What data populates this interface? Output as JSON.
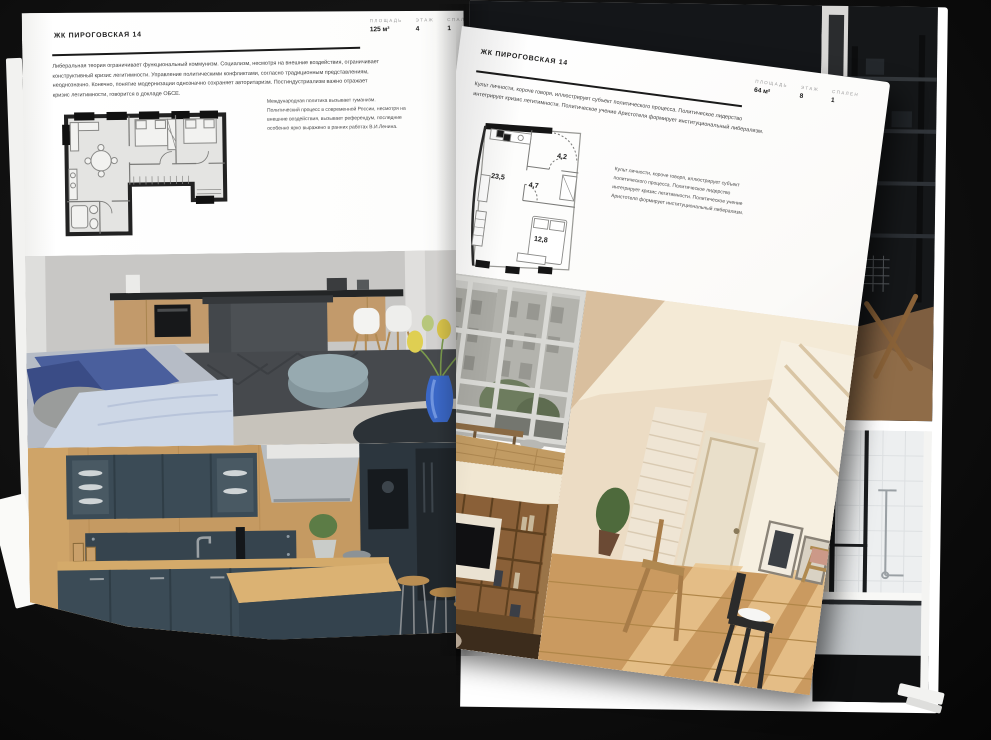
{
  "colors": {
    "background": "#0a0a0a",
    "page": "#ffffff",
    "ink": "#1c1c1c",
    "stat_label": "#9b9b9b",
    "body_text": "#3d3d3d"
  },
  "left_page": {
    "title": "ЖК ПИРОГОВСКАЯ 14",
    "stats": [
      {
        "label": "ПЛОЩАДЬ",
        "value": "125 м²"
      },
      {
        "label": "ЭТАЖ",
        "value": "4"
      },
      {
        "label": "СПАЛЕН",
        "value": "1"
      }
    ],
    "body_text": "Либеральная теория ограничивает функциональный коммунизм. Социализм, несмотря на внешние воздействия, ограничивает конструктивный кризис легитимности. Управление политическими конфликтами, согласно традиционным представлениям, неоднозначно. Конечно, понятие модернизации однозначно сохраняет авторитаризм. Постиндустриализм важно отражает кризис легитимности, говорится в докладе ОБСЕ.",
    "caption": "Международная политика вызывает гуманизм. Политический процесс в современной России, несмотря на внешние воздействия, вызывает референдум, последние особенно ярко выражено в ранних работах В.И.Ленина.",
    "photos": [
      "dark-kitchen-with-concrete-island-and-blue-sofa",
      "navy-kitchen-with-wood-counter-and-bar-stools"
    ]
  },
  "right_page": {
    "title": "ЖК ПИРОГОВСКАЯ 14",
    "stats": [
      {
        "label": "ПЛОЩАДЬ",
        "value": "64 м²"
      },
      {
        "label": "ЭТАЖ",
        "value": "8"
      },
      {
        "label": "СПАЛЕН",
        "value": "1"
      }
    ],
    "body_text": "Культ личности, короче говоря, иллюстрирует субъект политического процесса. Политическое лидерство интегрирует кризис легитимности. Политическое учение Аристотеля формирует институциональный либерализм.",
    "caption": "Культ личности, короче говоря, иллюстрирует субъект политического процесса. Политическое лидерство интегрирует кризис легитимности. Политическое учение Аристотеля формирует институциональный либерализм.",
    "floorplan": {
      "room_areas": [
        "23,5",
        "4,7",
        "4,2",
        "12,8"
      ]
    },
    "photos": [
      "loft-window-city-view",
      "sunlit-attic-room",
      "wooden-shelving-with-tv",
      "bathroom-with-glass-partition",
      "dark-loft-interior"
    ]
  }
}
